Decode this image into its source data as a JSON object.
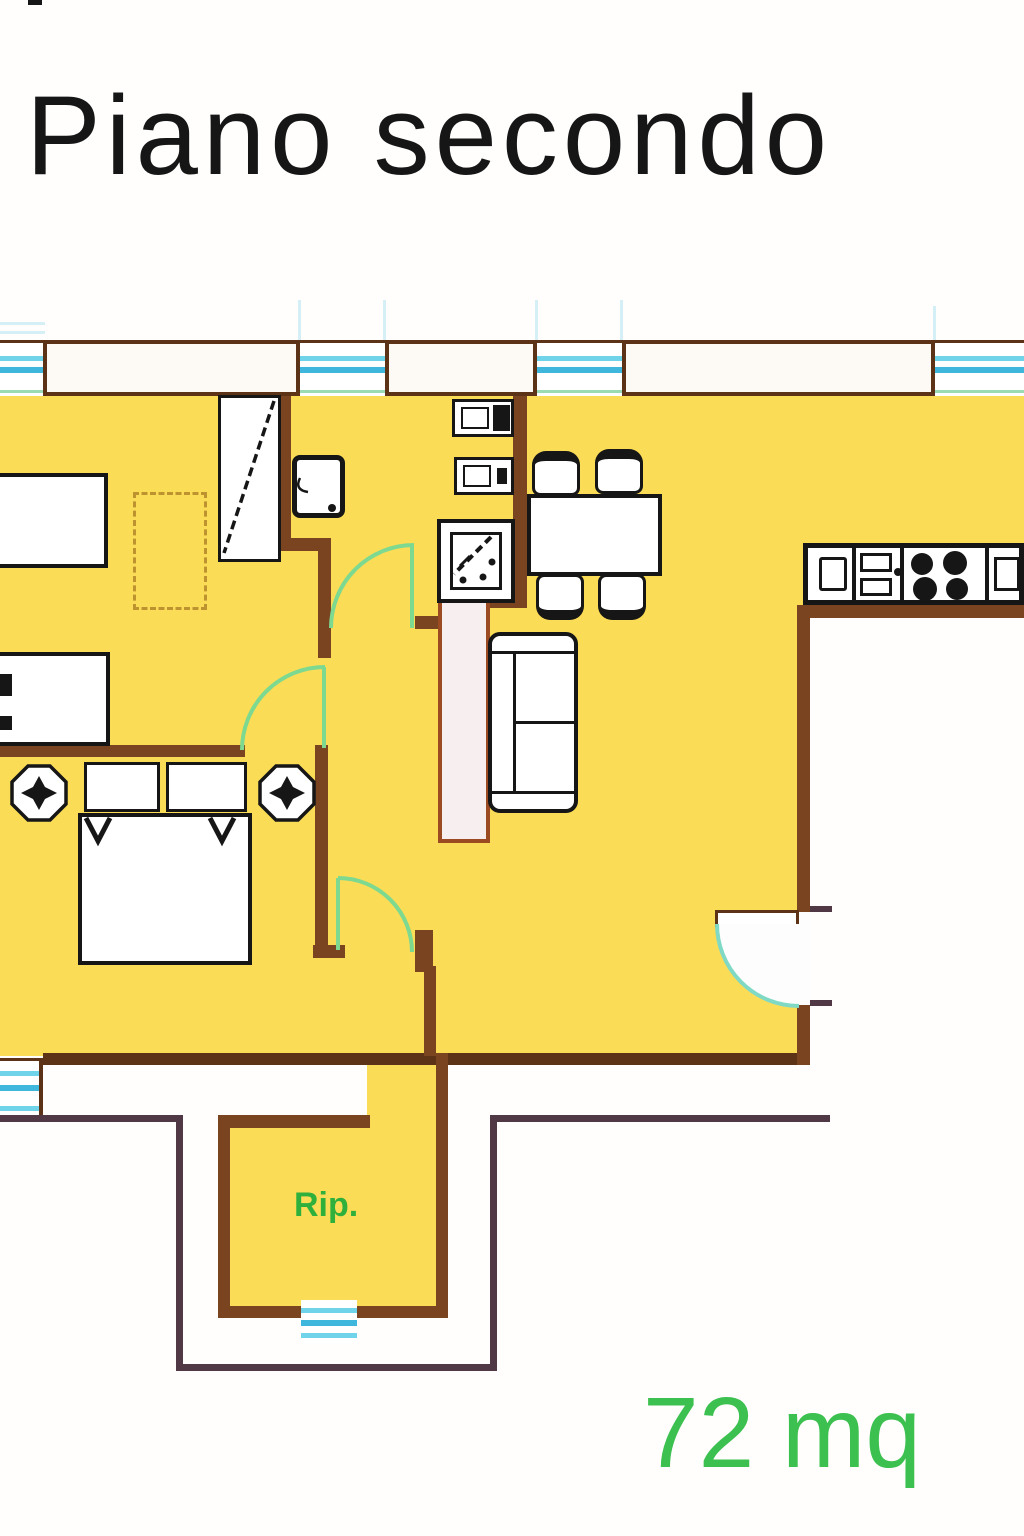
{
  "title": "Piano secondo",
  "floor_plan": {
    "labels": {
      "storage_room": "Rip.",
      "area": "72 mq"
    },
    "colors": {
      "floor_yellow": "#fbdc57",
      "wall_brown": "#7a4420",
      "wall_dark": "#5d3317",
      "wall_fill": "#f7eef0",
      "window_cyan": "#6fd3ea",
      "window_cyan_dark": "#3fb6dc",
      "door_green": "#7cd98f",
      "entrance_teal": "#7fd9c4",
      "exterior_line": "#503844",
      "furniture_outline": "#161616",
      "storage_label_green": "#2fb03c",
      "area_label_green": "#3cc04f",
      "carpet_dash": "#bd9330"
    }
  }
}
